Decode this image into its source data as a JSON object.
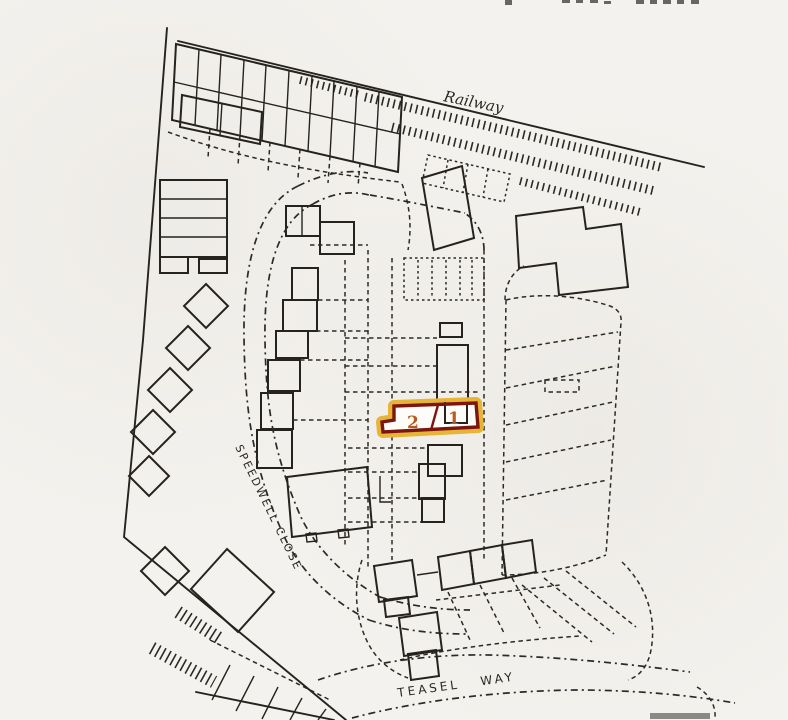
{
  "map": {
    "labels": {
      "railway": "Railway",
      "speedwell_close": "SPEEDWELL CLOSE",
      "teasel_way": "TEASEL WAY"
    },
    "plot": {
      "units": [
        {
          "number": "2"
        },
        {
          "number": "1"
        }
      ],
      "outline_color": "#7d150f",
      "halo_color": "#e6b538",
      "number_color": "#b65a1f"
    },
    "ink_color": "#2c2a25",
    "paper_color": "#f4f2ee"
  }
}
